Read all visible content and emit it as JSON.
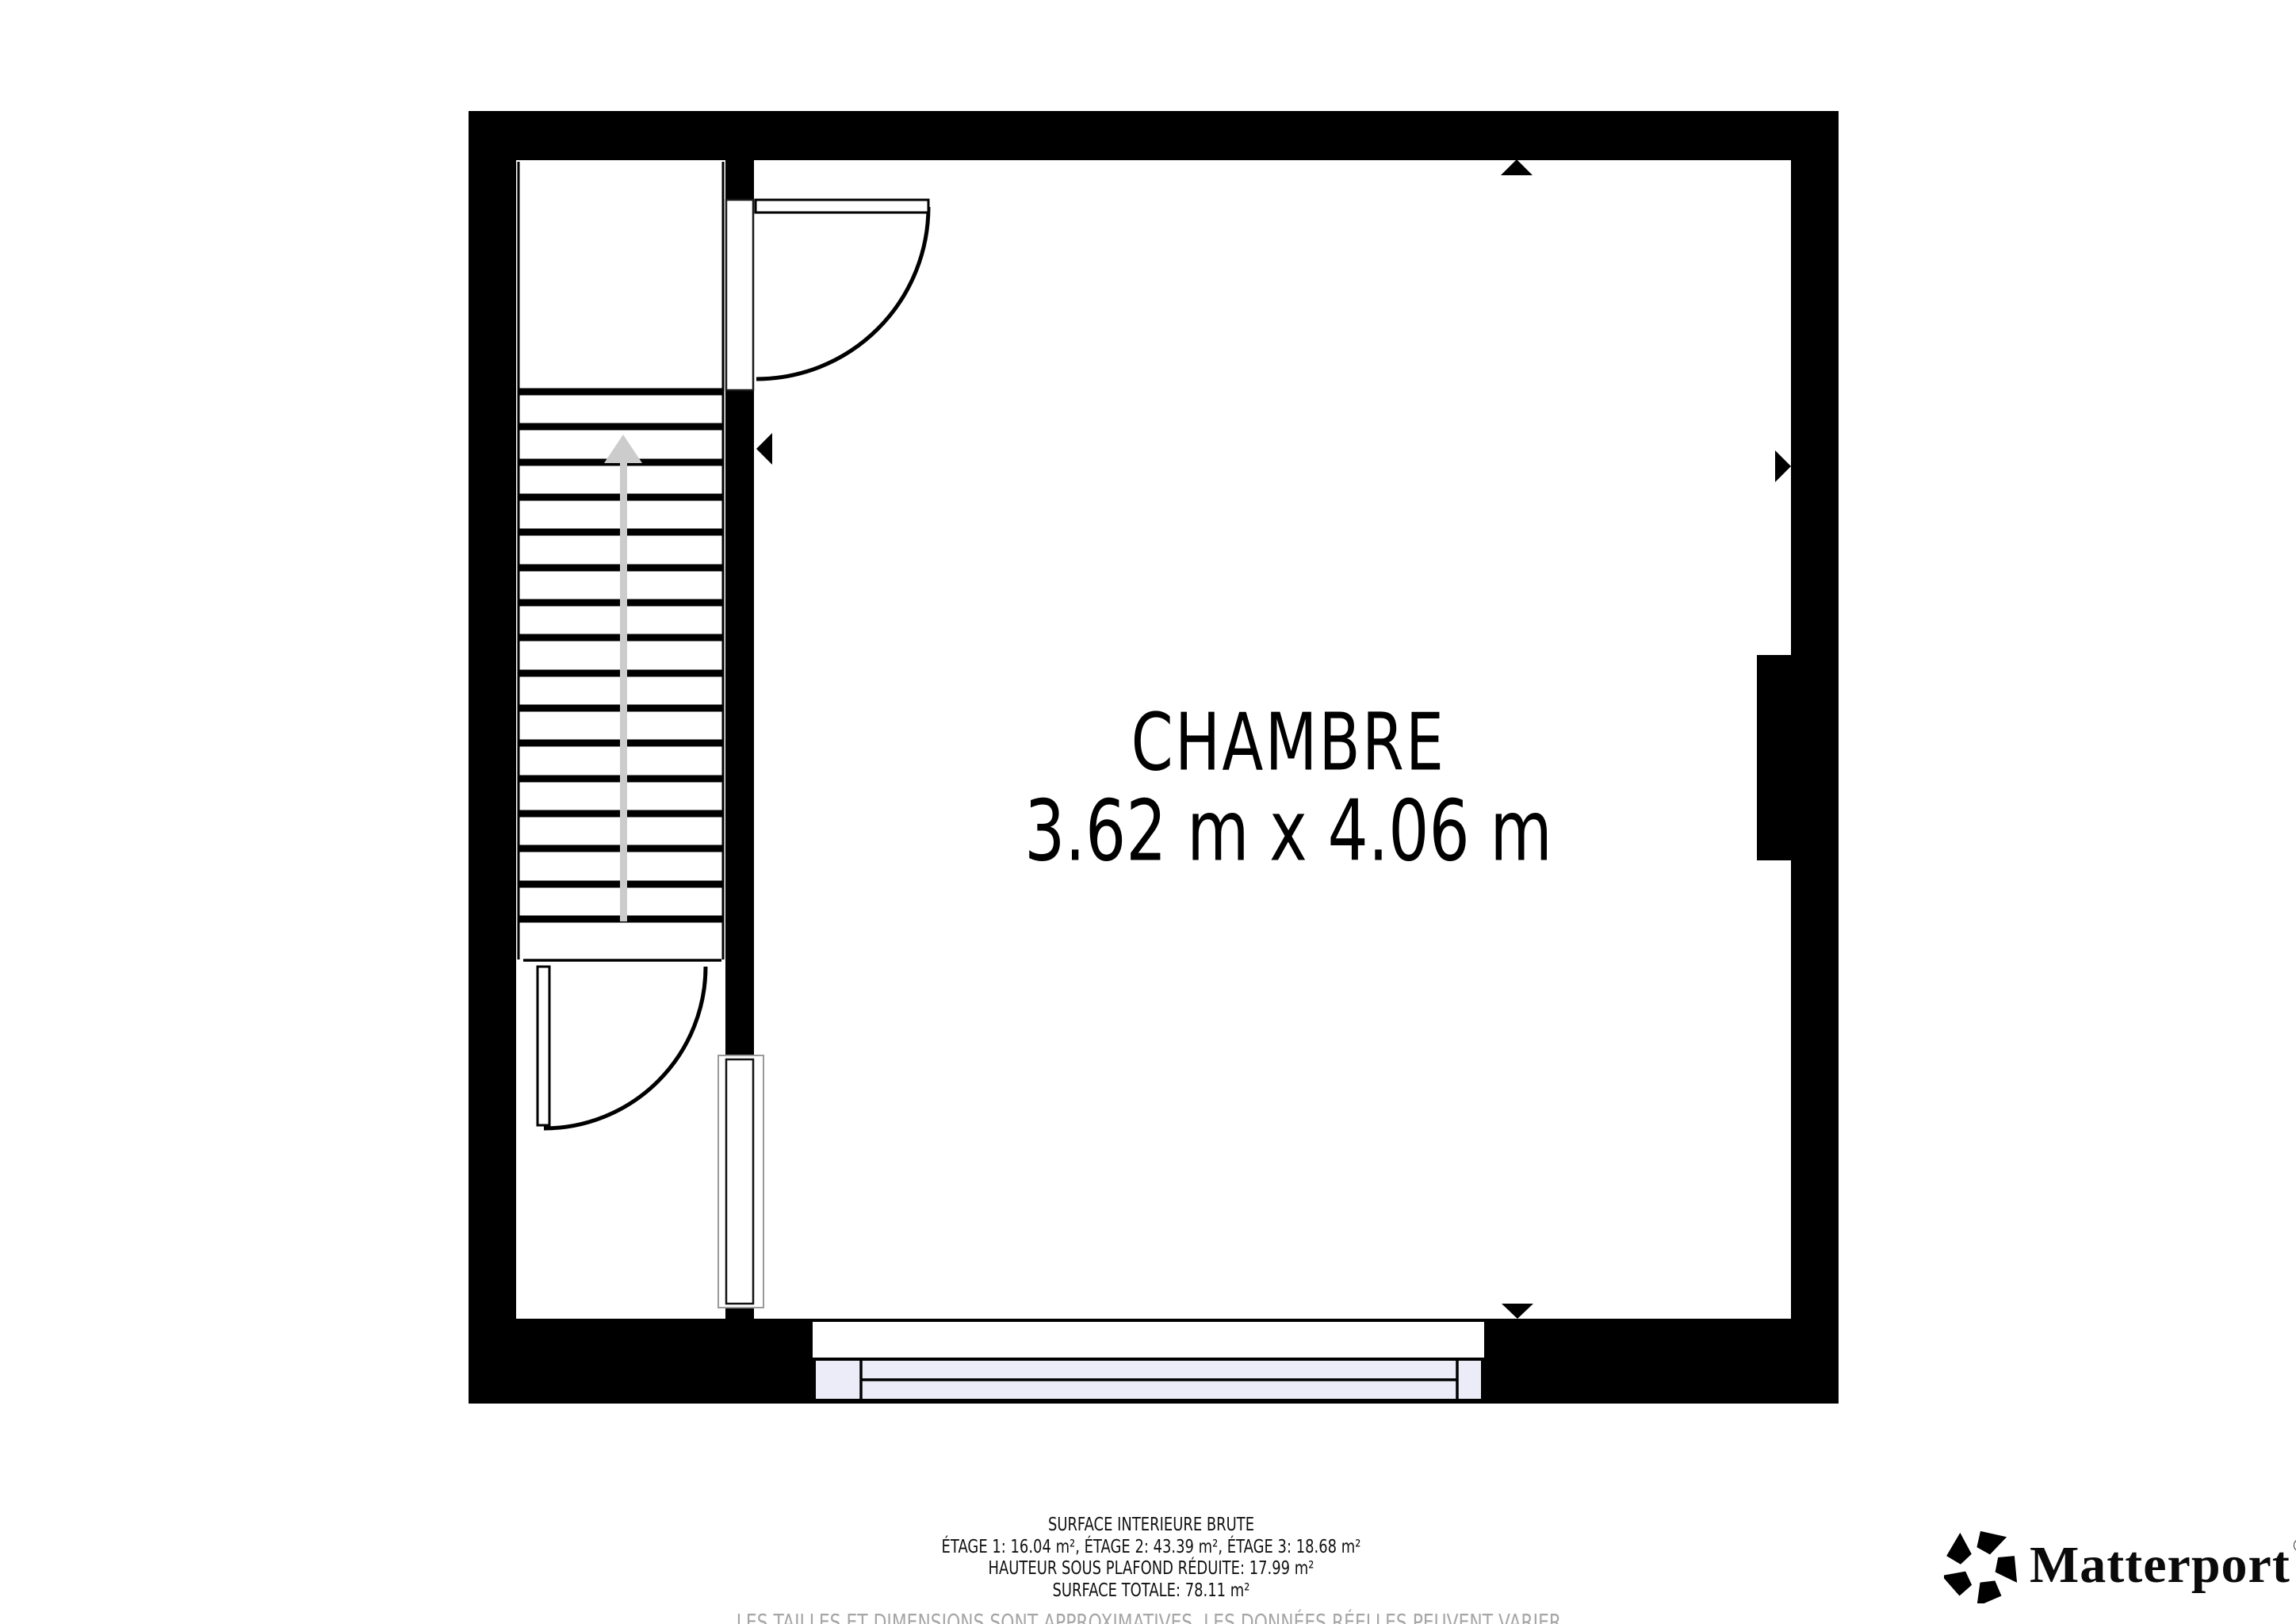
{
  "room": {
    "name": "CHAMBRE",
    "dimensions": "3.62 m x 4.06 m"
  },
  "footer": {
    "line1": "SURFACE INTERIEURE BRUTE",
    "line2": "ÉTAGE 1: 16.04 m², ÉTAGE 2: 43.39 m², ÉTAGE 3: 18.68 m²",
    "line3": "HAUTEUR SOUS PLAFOND RÉDUITE: 17.99 m²",
    "line4": "SURFACE TOTALE: 78.11 m²",
    "disclaimer": "LES TAILLES ET DIMENSIONS SONT APPROXIMATIVES, LES DONNÉES RÉELLES PEUVENT VARIER."
  },
  "branding": {
    "logo_text": "Matterport",
    "registered_mark": "®"
  },
  "colors": {
    "wall": "#000000",
    "door_line": "#000000",
    "window_fill": "#ececf8",
    "stair_arrow": "#cccccc",
    "disclaimer_gray": "#a6a6a6",
    "outline_gray": "#9a9a9a"
  }
}
